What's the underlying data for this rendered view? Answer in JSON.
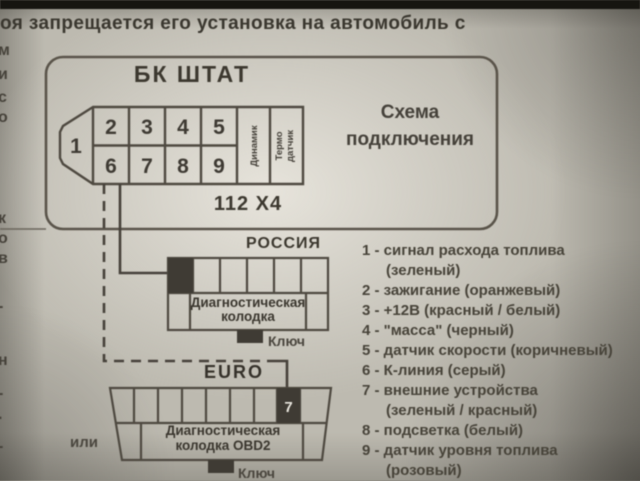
{
  "page": {
    "top_text": "оя запрещается его установка на автомобиль с",
    "left_margin_fragments": [
      "м",
      "и",
      "с",
      "о",
      "к",
      "о",
      "в",
      "-",
      "н",
      "-",
      "·",
      "-"
    ]
  },
  "scheme_box": {
    "connector_title": "БК ШТАТ",
    "scheme_label_line1": "Схема",
    "scheme_label_line2": "подключения",
    "connector_model": "112 X4",
    "pin1": "1",
    "pins_top": [
      "2",
      "3",
      "4",
      "5"
    ],
    "pins_bottom": [
      "6",
      "7",
      "8",
      "9"
    ],
    "speaker_column_label": "Динамик",
    "thermo_column_label_line1": "Термо",
    "thermo_column_label_line2": "датчик"
  },
  "russia_connector": {
    "title": "РОССИЯ",
    "label_line1": "Диагностическая",
    "label_line2": "колодка",
    "key_label": "Ключ"
  },
  "euro_connector": {
    "title": "EURO",
    "or_label": "или",
    "pin7_label": "7",
    "label_line1": "Диагностическая",
    "label_line2": "колодка OBD2",
    "key_label": "Ключ"
  },
  "legend": {
    "items": [
      {
        "line1": "1 - сигнал расхода топлива",
        "line2": "(зеленый)"
      },
      {
        "line1": "2 - зажигание (оранжевый)"
      },
      {
        "line1": "3 - +12В (красный / белый)"
      },
      {
        "line1": "4 - \"масса\" (черный)"
      },
      {
        "line1": "5 - датчик скорости (коричневый)"
      },
      {
        "line1": "6 - К-линия (серый)"
      },
      {
        "line1": "7 - внешние устройства",
        "line2": "(зеленый / красный)"
      },
      {
        "line1": "8 - подсветка (белый)"
      },
      {
        "line1": "9 - датчик уровня топлива",
        "line2": "(розовый)"
      }
    ]
  },
  "colors": {
    "paper": "#c9c6bc",
    "ink": "#3e3a33",
    "line": "#524d43",
    "dark_cell": "#3f3b34",
    "photo_edge": "#161510"
  }
}
